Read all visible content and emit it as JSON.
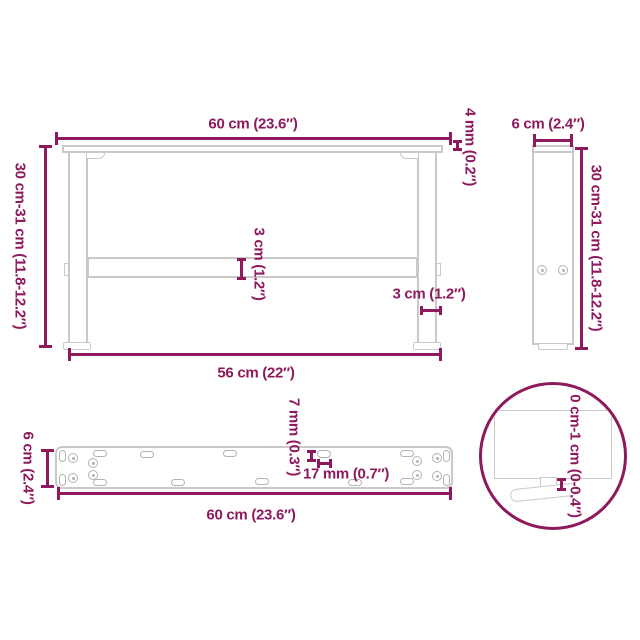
{
  "colors": {
    "accent": "#8E195D",
    "outline": "#c9c9c9",
    "outline2": "#b3b3b3"
  },
  "views": {
    "front": {
      "dims": {
        "width_top": "60 cm (23.6″)",
        "plate_thickness": "4 mm (0.2″)",
        "height": "30 cm-31 cm (11.8-12.2″)",
        "crossbar": "3 cm (1.2″)",
        "leg_width": "3 cm (1.2″)",
        "width_bottom": "56 cm (22″)"
      }
    },
    "side": {
      "dims": {
        "depth": "6 cm (2.4″)",
        "height": "30 cm-31 cm (11.8-12.2″)"
      }
    },
    "plate": {
      "dims": {
        "depth": "6 cm (2.4″)",
        "slot_height": "7 mm (0.3″)",
        "slot_length": "17 mm (0.7″)",
        "length": "60 cm (23.6″)"
      }
    },
    "detail": {
      "dims": {
        "foot_adjustment": "0 cm-1 cm (0-0.4″)"
      }
    }
  }
}
